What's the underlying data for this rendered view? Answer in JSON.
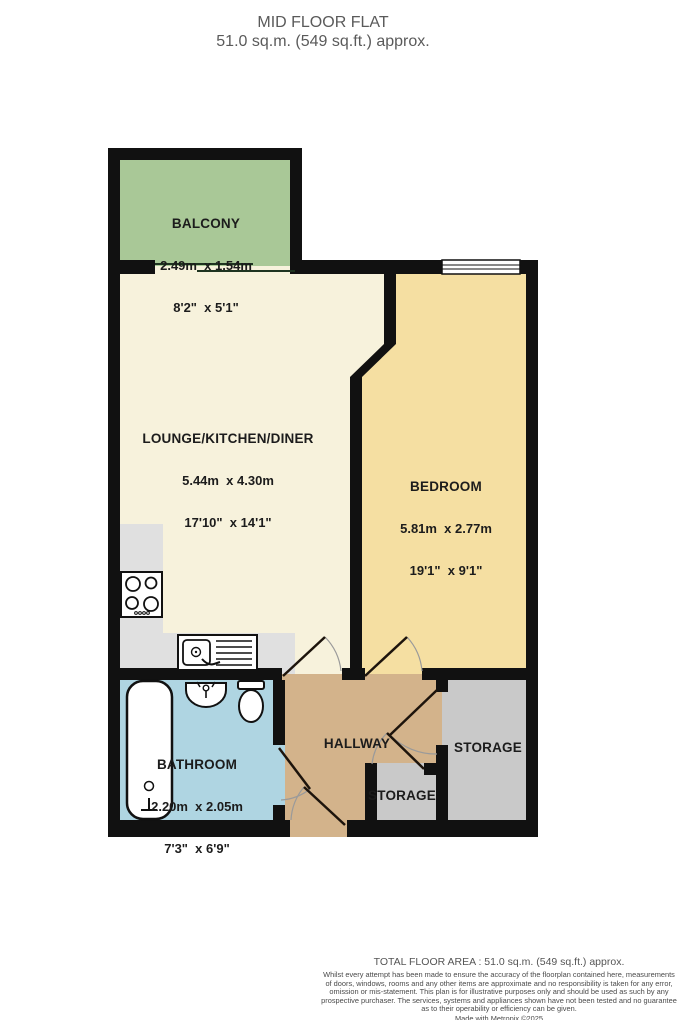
{
  "header": {
    "title": "MID FLOOR FLAT",
    "subtitle": "51.0 sq.m. (549 sq.ft.) approx."
  },
  "rooms": {
    "balcony": {
      "name": "BALCONY",
      "metric": "2.49m  x 1.54m",
      "imperial": "8'2\"  x 5'1\""
    },
    "lounge": {
      "name": "LOUNGE/KITCHEN/DINER",
      "metric": "5.44m  x 4.30m",
      "imperial": "17'10\"  x 14'1\""
    },
    "bedroom": {
      "name": "BEDROOM",
      "metric": "5.81m  x 2.77m",
      "imperial": "19'1\"  x 9'1\""
    },
    "bathroom": {
      "name": "BATHROOM",
      "metric": "2.20m  x 2.05m",
      "imperial": "7'3\"  x 6'9\""
    },
    "hallway": {
      "name": "HALLWAY"
    },
    "storage_large": {
      "name": "STORAGE"
    },
    "storage_small": {
      "name": "STORAGE"
    }
  },
  "footer": {
    "total": "TOTAL FLOOR AREA : 51.0 sq.m. (549 sq.ft.) approx.",
    "disclaimer_lines": [
      "Whilst every attempt has been made to ensure the accuracy of the floorplan contained here, measurements",
      "of doors, windows, rooms and any other items are approximate and no responsibility is taken for any error,",
      "omission or mis-statement. This plan is for illustrative purposes only and should be used as such by any",
      "prospective purchaser. The services, systems and appliances shown have not been tested and no guarantee",
      "as to their operability or efficiency can be given."
    ],
    "credit": "Made with Metropix ©2025"
  },
  "colors": {
    "wall": "#111111",
    "balcony": "#a9c897",
    "lounge": "#f7f2dc",
    "bedroom": "#f5dfa2",
    "bathroom": "#afd5e2",
    "hallway": "#d3b38b",
    "storage": "#c9c9c9",
    "counter": "#e0e0e0"
  }
}
